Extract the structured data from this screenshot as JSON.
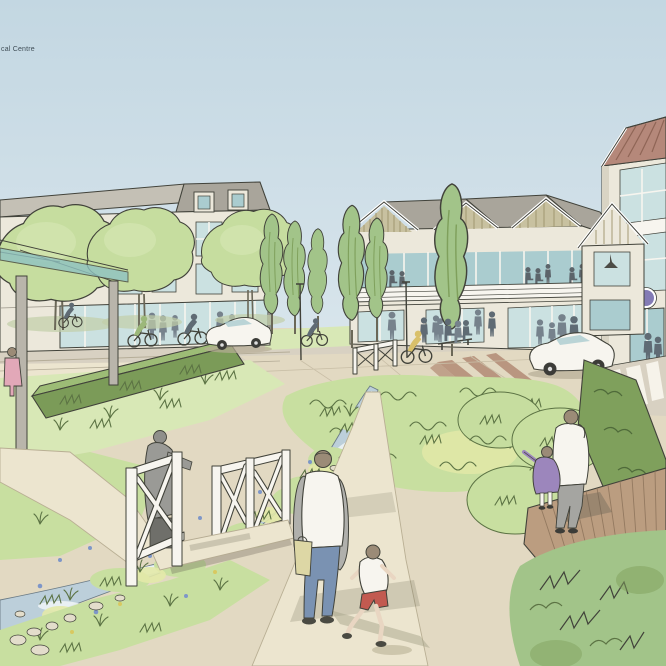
{
  "scene": {
    "caption": "cal Centre"
  },
  "palette": {
    "caption_ink": "#3f4d56",
    "sky_top": "#c3d7e2",
    "sky_bottom": "#dde8ee",
    "ink": "#41423a",
    "ink_olive": "#5c7344",
    "wall_cream": "#ece8db",
    "wall_shade": "#d9d4c4",
    "roof_grey": "#a9a59b",
    "roof_light": "#c4c0b5",
    "timber": "#c8c1a0",
    "timber_stripe": "#a39a76",
    "roof_red": "#b5887a",
    "roof_red_stripe": "#8f6556",
    "glass": "#cbe1e1",
    "glass_deep": "#aacccf",
    "canopy": "#8fc2c2",
    "post_grey": "#b9b5ab",
    "tree_light": "#c6dd9f",
    "tree_highlight": "#dcebbc",
    "tree_mid": "#a2c489",
    "tree_dark": "#7fa05c",
    "grass_light": "#d8e8b6",
    "grass_mid": "#c8dfa0",
    "meadow_yellow": "#e3e9a8",
    "hedge_top": "#9dbc76",
    "hedge_front": "#7b9b58",
    "path_cream": "#ece5cf",
    "paving": "#e2d9c2",
    "paving_red": "#b28a74",
    "road": "#d8d1c2",
    "stream": "#bccfda",
    "water_light": "#edf3f5",
    "flower_blue": "#7e96c8",
    "boardwalk": "#bb9d80",
    "plank": "#8a7058",
    "shadow": "#9a9582",
    "silhouette": "#76828c",
    "silhouette_dark": "#5f6b74",
    "white": "#f7f5ef",
    "jeans": "#7a92b2",
    "coat_grey": "#b0b0ac",
    "jacket_grey": "#9a9a96",
    "shorts_red": "#c25a50",
    "coat_purple": "#9c86bc",
    "coat_pink": "#e2a8b8",
    "bag_yellow": "#ddd7a5",
    "hair": "#9b8b77",
    "jacket_yellow": "#d9c06a",
    "shirt_green": "#9cb87a",
    "sign_purple": "#837bb5",
    "skin": "#e9d6c2"
  }
}
